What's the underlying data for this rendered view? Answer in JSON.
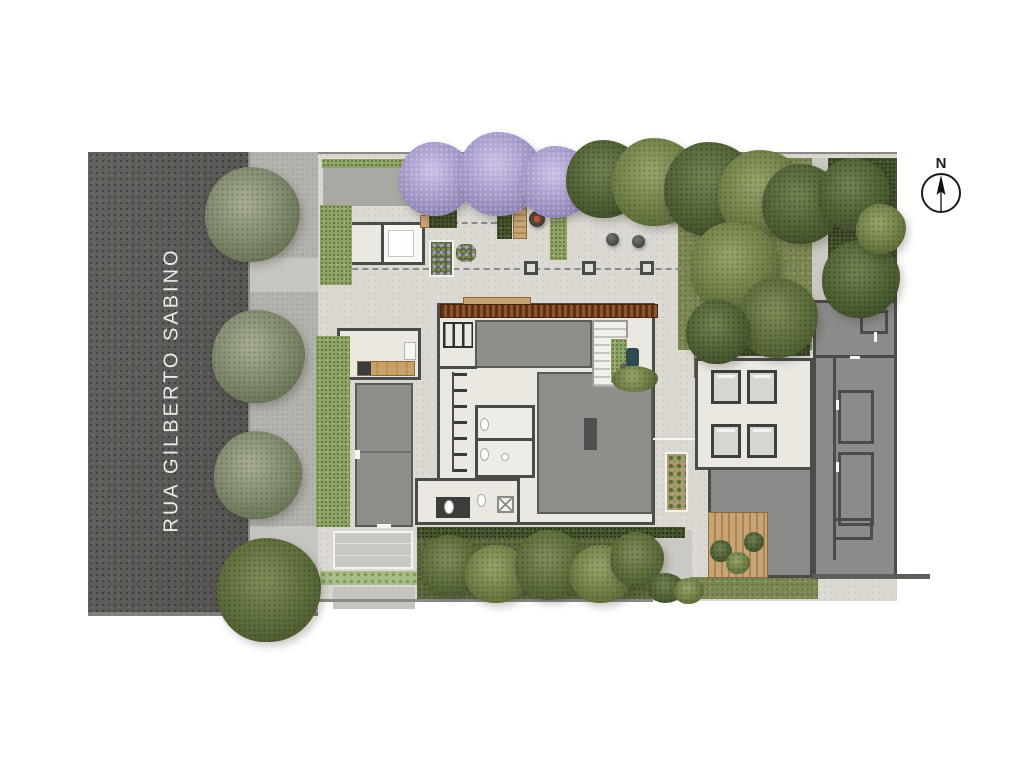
{
  "street": {
    "name": "RUA GILBERTO SABINO"
  },
  "compass": {
    "label": "N"
  },
  "colors": {
    "street": "#5b5a57",
    "sidewalk": "#b5b3ae",
    "plaza": "#dbd9d2",
    "floor": "#eae8e1",
    "roof": "#8e8e8b",
    "wall": "#4b4b49",
    "lawn": "#7d8955",
    "hedge-dark": "#46542f",
    "hedge-bright": "#8fa566",
    "garden": "#5d6b40",
    "wood": "#c7a274",
    "pergola": "#6e3f24",
    "court": "#c9c8c2",
    "paver": "#a9bd89",
    "street-text": "#eceae7",
    "line": "#8a8984",
    "bench-yellow": "#dfa23b",
    "stool-pink": "#c76f9f",
    "firepit-ember": "#c2542f",
    "jacaranda": "#a89ccd"
  }
}
